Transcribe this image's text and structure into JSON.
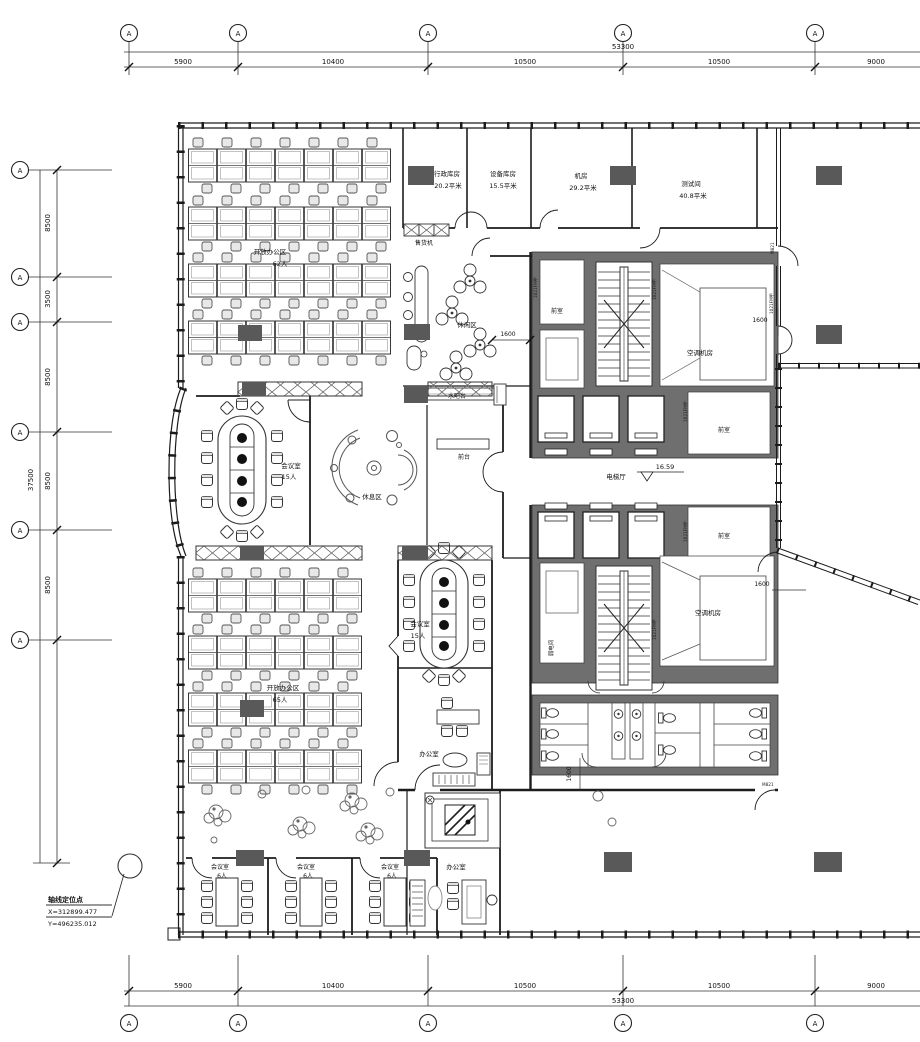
{
  "colors": {
    "line": "#1c1c1c",
    "wall_gray": "#6f6f6f",
    "column": "#595959",
    "chair_fill": "#e8e8e8"
  },
  "grid": {
    "letter": "A"
  },
  "dims": {
    "top": {
      "segments": [
        "5900",
        "10400",
        "10500",
        "10500",
        "9000"
      ],
      "total": "53300"
    },
    "bottom": {
      "segments": [
        "5900",
        "10400",
        "10500",
        "10500",
        "9000"
      ],
      "total": "53300"
    },
    "left": {
      "segments": [
        "8500",
        "3500",
        "8500",
        "8500",
        "8500"
      ],
      "total": "37500"
    },
    "clear": "1600"
  },
  "rooms": {
    "admin_store": {
      "name": "行政库房",
      "area": "20.2平米"
    },
    "equip_store": {
      "name": "设备库房",
      "area": "15.5平米"
    },
    "server": {
      "name": "机房",
      "area": "29.2平米"
    },
    "test": {
      "name": "测试间",
      "area": "40.8平米"
    },
    "open_office_n": {
      "name": "开放办公区",
      "capacity": "62人"
    },
    "open_office_s": {
      "name": "开放办公区",
      "capacity": "65人"
    },
    "meeting_w": {
      "name": "会议室",
      "capacity": "15人"
    },
    "meeting_c": {
      "name": "会议室",
      "capacity": "15人"
    },
    "meeting_s1": {
      "name": "会议室",
      "capacity": "6人"
    },
    "meeting_s2": {
      "name": "会议室",
      "capacity": "6人"
    },
    "meeting_s3": {
      "name": "会议室",
      "capacity": "6人"
    },
    "office_c": {
      "name": "办公室"
    },
    "office_s": {
      "name": "办公室"
    },
    "lounge": {
      "name": "休闲区"
    },
    "rest": {
      "name": "休息区"
    },
    "water_bar": {
      "name": "水吧台"
    },
    "reception": {
      "name": "前台"
    },
    "vending": {
      "name": "售货机"
    },
    "hvac_n": {
      "name": "空调机房"
    },
    "hvac_s": {
      "name": "空调机房"
    },
    "ante_core": {
      "name": "前室"
    },
    "ante_n": {
      "name": "前室"
    },
    "ante_s": {
      "name": "前室"
    },
    "weak_elec": {
      "name": "弱电间"
    },
    "elev_lobby": {
      "name": "电梯厅"
    }
  },
  "annotations": {
    "datum": {
      "title": "轴线定位点",
      "x": "X=312899.477",
      "y": "Y=496235.012"
    },
    "level": "16.59",
    "door_code_fire": "1021FM甲",
    "door_code_m": "M821"
  }
}
